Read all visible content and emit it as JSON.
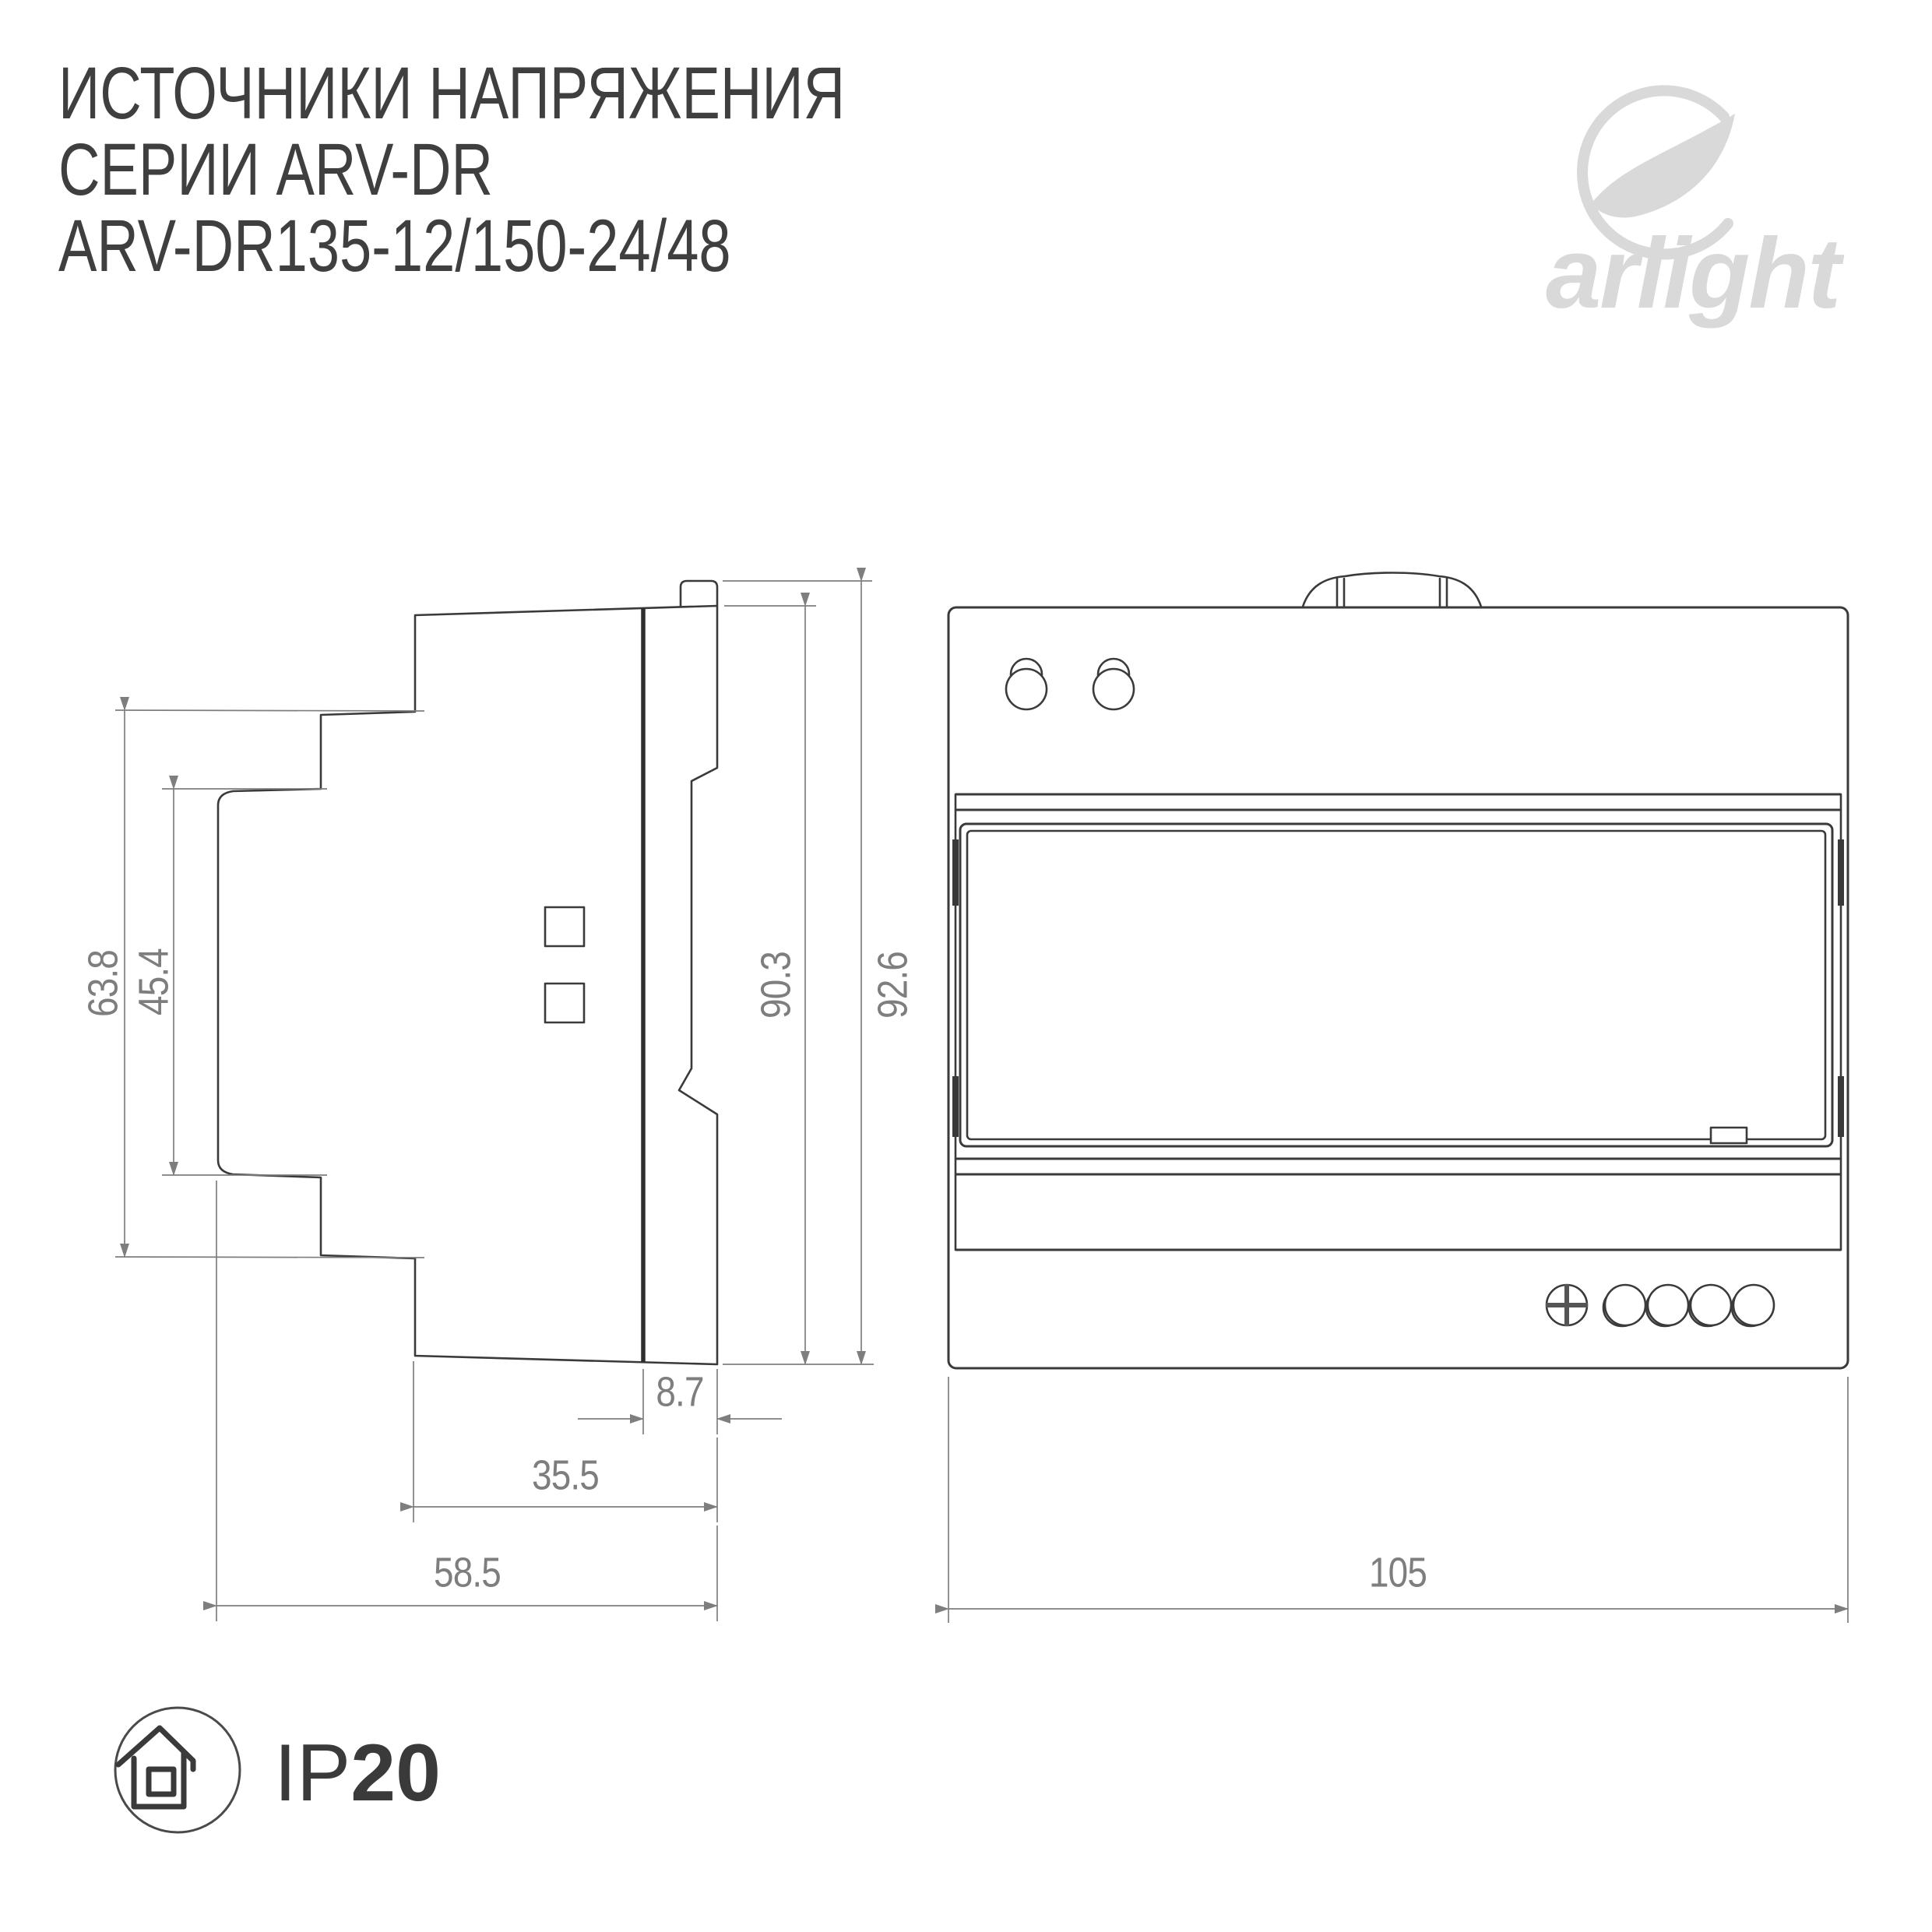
{
  "title": {
    "lines": [
      "ИСТОЧНИКИ НАПРЯЖЕНИЯ",
      "СЕРИИ ARV-DR",
      "ARV-DR135-12/150-24/48"
    ]
  },
  "logo": {
    "wordmark": "arlight"
  },
  "icons": {
    "logo_symbol": "arlight-swoosh",
    "ip_enclosure": "house-in-circle"
  },
  "side_view": {
    "dim_height_step": "63.8",
    "dim_height_recess": "45.4",
    "dim_height_body": "90.3",
    "dim_height_total": "92.6",
    "dim_depth_rear": "8.7",
    "dim_depth_front": "35.5",
    "dim_depth_total": "58.5"
  },
  "front_view": {
    "dim_width": "105"
  },
  "ip_badge": {
    "prefix": "IP",
    "rating": "20"
  },
  "colors": {
    "line": "#3a3a3a",
    "dimension": "#7e7e7e",
    "logo": "#d9d9d9",
    "text": "#3f3f3f"
  }
}
